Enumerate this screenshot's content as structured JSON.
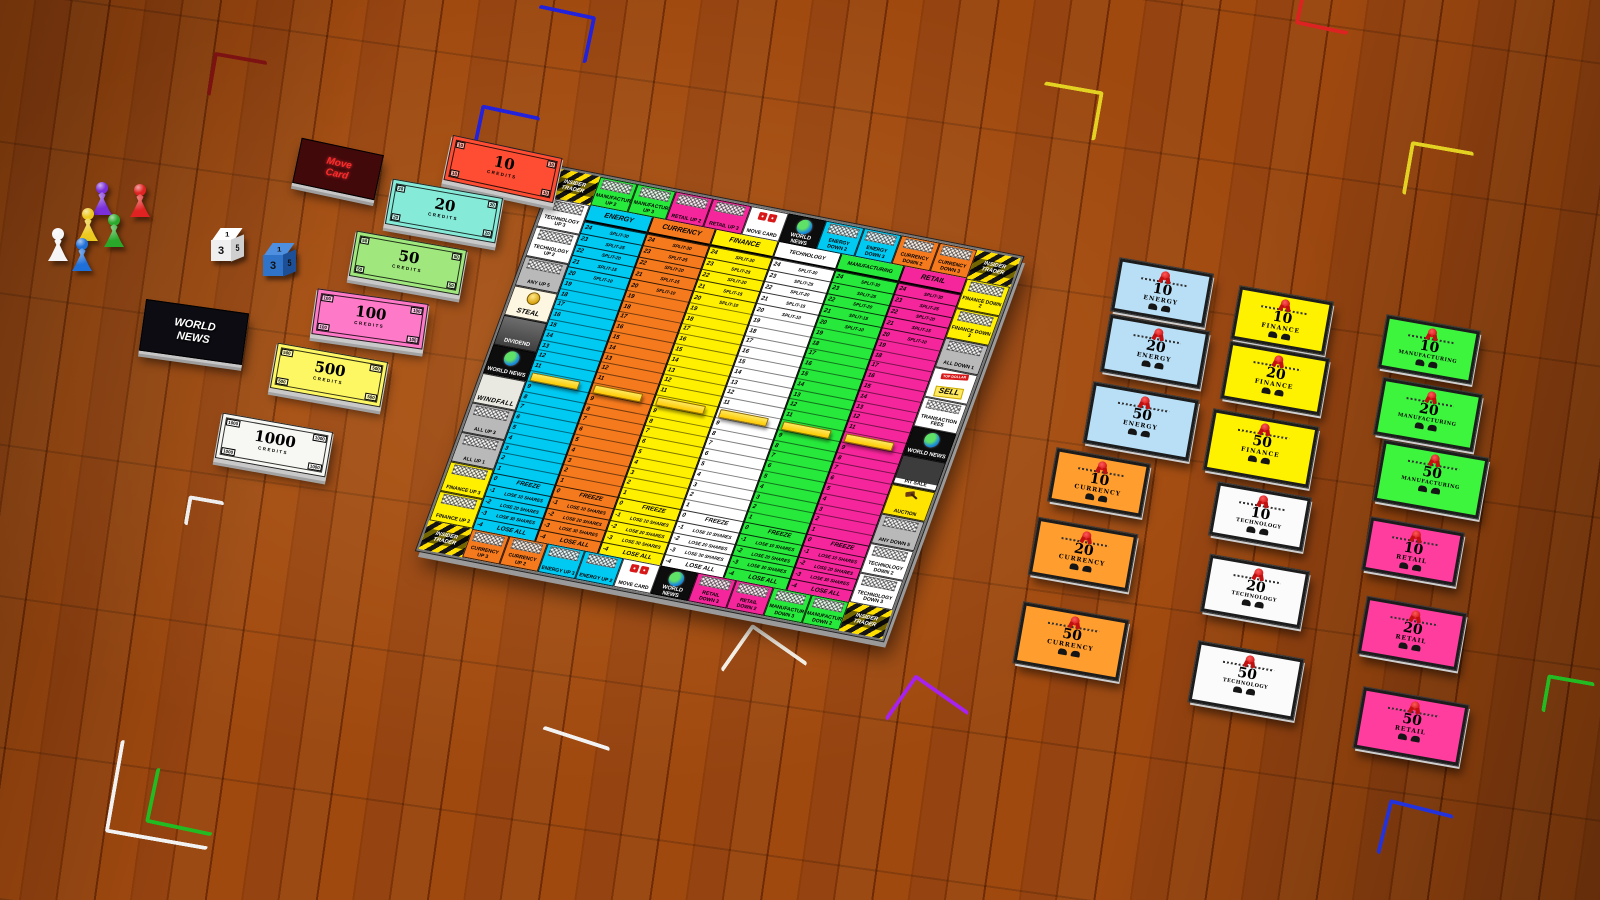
{
  "scene": {
    "marker_value": "10",
    "marker_color": "#ffd500"
  },
  "board": {
    "corner_label": "INSIDER TRADER",
    "sectors": [
      {
        "name": "ENERGY",
        "color": "#00c9f2"
      },
      {
        "name": "CURRENCY",
        "color": "#f57a1e"
      },
      {
        "name": "FINANCE",
        "color": "#fff000"
      },
      {
        "name": "TECHNOLOGY",
        "color": "#ffffff"
      },
      {
        "name": "MANUFACTURING",
        "color": "#27e93c"
      },
      {
        "name": "RETAIL",
        "color": "#f5269b"
      }
    ],
    "split_rows": [
      {
        "price": "24",
        "label": "SPLIT-30"
      },
      {
        "price": "23",
        "label": "SPLIT-25"
      },
      {
        "price": "22",
        "label": "SPLIT-20"
      },
      {
        "price": "21",
        "label": "SPLIT-15"
      },
      {
        "price": "20",
        "label": "SPLIT-10"
      }
    ],
    "price_numbers": [
      "19",
      "18",
      "17",
      "16",
      "15",
      "14",
      "13",
      "12",
      "11",
      "10",
      "9",
      "8",
      "7",
      "6",
      "5",
      "4",
      "3",
      "2",
      "1"
    ],
    "penalty_rows": [
      {
        "price": "0",
        "label": "FREEZE",
        "big": true
      },
      {
        "price": "-1",
        "label": "LOSE 10 SHARES"
      },
      {
        "price": "-2",
        "label": "LOSE 20 SHARES"
      },
      {
        "price": "-3",
        "label": "LOSE 30 SHARES"
      },
      {
        "price": "-4",
        "label": "LOSE ALL",
        "big": true
      }
    ],
    "edges": {
      "top": [
        {
          "label": "MANUFACTURING UP 2",
          "type": "green"
        },
        {
          "label": "MANUFACTURING UP 3",
          "type": "green"
        },
        {
          "label": "RETAIL UP 2",
          "type": "magenta"
        },
        {
          "label": "RETAIL UP 3",
          "type": "magenta"
        },
        {
          "label": "MOVE CARD",
          "type": "movecard"
        },
        {
          "label": "WORLD NEWS",
          "type": "news"
        },
        {
          "label": "ENERGY DOWN 2",
          "type": "cyan"
        },
        {
          "label": "ENERGY DOWN 3",
          "type": "cyan"
        },
        {
          "label": "CURRENCY DOWN 2",
          "type": "orange"
        },
        {
          "label": "CURRENCY DOWN 3",
          "type": "orange"
        }
      ],
      "right": [
        {
          "label": "FINANCE DOWN 2",
          "type": "yellow"
        },
        {
          "label": "FINANCE DOWN 3",
          "type": "yellow"
        },
        {
          "label": "ALL DOWN 1",
          "type": "gray"
        },
        {
          "label": "SELL",
          "type": "sell",
          "tag": "TOP DOLLAR"
        },
        {
          "label": "TRANSACTION FEES",
          "type": "white"
        },
        {
          "label": "WORLD NEWS",
          "type": "news"
        },
        {
          "label": "PIT SALE",
          "type": "pit"
        },
        {
          "label": "AUCTION",
          "type": "auction"
        },
        {
          "label": "ANY DOWN 5",
          "type": "gray"
        },
        {
          "label": "TECHNOLOGY DOWN 2",
          "type": "white"
        },
        {
          "label": "TECHNOLOGY DOWN 3",
          "type": "white"
        }
      ],
      "bottom": [
        {
          "label": "CURRENCY UP 3",
          "type": "orange"
        },
        {
          "label": "CURRENCY UP 2",
          "type": "orange"
        },
        {
          "label": "ENERGY UP 3",
          "type": "cyan"
        },
        {
          "label": "ENERGY UP 2",
          "type": "cyan"
        },
        {
          "label": "MOVE CARD",
          "type": "movecard"
        },
        {
          "label": "WORLD NEWS",
          "type": "news"
        },
        {
          "label": "RETAIL DOWN 3",
          "type": "magenta"
        },
        {
          "label": "RETAIL DOWN 2",
          "type": "magenta"
        },
        {
          "label": "MANUFACTURING DOWN 3",
          "type": "green"
        },
        {
          "label": "MANUFACTURING DOWN 2",
          "type": "green"
        }
      ],
      "left": [
        {
          "label": "TECHNOLOGY UP 3",
          "type": "white"
        },
        {
          "label": "TECHNOLOGY UP 2",
          "type": "white"
        },
        {
          "label": "ANY UP 5",
          "type": "gray"
        },
        {
          "label": "STEAL",
          "type": "steal"
        },
        {
          "label": "DIVIDEND",
          "type": "dividend"
        },
        {
          "label": "WORLD NEWS",
          "type": "news"
        },
        {
          "label": "WINDFALL",
          "type": "windfall"
        },
        {
          "label": "ALL UP 3",
          "type": "gray"
        },
        {
          "label": "ALL UP 1",
          "type": "gray"
        },
        {
          "label": "FINANCE UP 3",
          "type": "yellow"
        },
        {
          "label": "FINANCE UP 2",
          "type": "yellow"
        }
      ]
    }
  },
  "money_notes": [
    {
      "value": "10",
      "label": "CREDITS",
      "color": "#ff4d33",
      "x": 447,
      "y": 146,
      "rot": 12
    },
    {
      "value": "20",
      "label": "CREDITS",
      "color": "#86ead9",
      "x": 388,
      "y": 188,
      "rot": 10
    },
    {
      "value": "50",
      "label": "CREDITS",
      "color": "#a0e87d",
      "x": 352,
      "y": 240,
      "rot": 10
    },
    {
      "value": "100",
      "label": "CREDITS",
      "color": "#ff79c9",
      "x": 314,
      "y": 296,
      "rot": 8
    },
    {
      "value": "500",
      "label": "CREDITS",
      "color": "#fdf763",
      "x": 273,
      "y": 352,
      "rot": 10
    },
    {
      "value": "1000",
      "label": "CREDITS",
      "color": "#f7f7f3",
      "x": 218,
      "y": 422,
      "rot": 10
    }
  ],
  "decks": {
    "move": {
      "label": "Move Card",
      "x": 296,
      "y": 146,
      "w": 84,
      "h": 46,
      "rot": 12,
      "bg": "#42090b",
      "text": "#ff2a2a"
    },
    "news": {
      "label": "WORLD NEWS",
      "x": 142,
      "y": 306,
      "w": 104,
      "h": 52,
      "rot": 8,
      "bg": "#0c0c12",
      "text": "#ffffff"
    }
  },
  "dice": [
    {
      "name": "white-die",
      "top": "1",
      "front": "3",
      "right": "5",
      "x": 210,
      "y": 228,
      "c_top": "#ffffff",
      "c_front": "#efefef",
      "c_right": "#cfcfcf"
    },
    {
      "name": "blue-die",
      "top": "1",
      "front": "3",
      "right": "5",
      "x": 262,
      "y": 243,
      "c_top": "#4e8fe0",
      "c_front": "#2f74c8",
      "c_right": "#1d4f96"
    }
  ],
  "pawns": [
    {
      "color_name": "purple",
      "color": "#7a2fd8",
      "x": 92,
      "y": 182
    },
    {
      "color_name": "red",
      "color": "#e02222",
      "x": 130,
      "y": 184
    },
    {
      "color_name": "yellow",
      "color": "#ecc91f",
      "x": 78,
      "y": 208
    },
    {
      "color_name": "green",
      "color": "#2aa82a",
      "x": 104,
      "y": 214
    },
    {
      "color_name": "white",
      "color": "#f5f5f5",
      "x": 48,
      "y": 228
    },
    {
      "color_name": "blue",
      "color": "#1f6fd8",
      "x": 72,
      "y": 238
    }
  ],
  "certificates": [
    {
      "sector": "ENERGY",
      "color": "#b8dff6",
      "cards": [
        {
          "value": "10",
          "x": 1115,
          "y": 266
        },
        {
          "value": "20",
          "x": 1105,
          "y": 323
        },
        {
          "value": "50",
          "x": 1088,
          "y": 391
        }
      ]
    },
    {
      "sector": "FINANCE",
      "color": "#fff200",
      "cards": [
        {
          "value": "10",
          "x": 1235,
          "y": 294
        },
        {
          "value": "20",
          "x": 1225,
          "y": 350
        },
        {
          "value": "50",
          "x": 1208,
          "y": 418
        }
      ]
    },
    {
      "sector": "MANUFACTURING",
      "color": "#3df53d",
      "cards": [
        {
          "value": "10",
          "x": 1382,
          "y": 323
        },
        {
          "value": "20",
          "x": 1378,
          "y": 386
        },
        {
          "value": "50",
          "x": 1378,
          "y": 449
        }
      ]
    },
    {
      "sector": "CURRENCY",
      "color": "#ff9d2e",
      "cards": [
        {
          "value": "10",
          "x": 1052,
          "y": 456
        },
        {
          "value": "20",
          "x": 1033,
          "y": 526
        },
        {
          "value": "50",
          "x": 1018,
          "y": 611
        }
      ]
    },
    {
      "sector": "TECHNOLOGY",
      "color": "#fbfbfb",
      "cards": [
        {
          "value": "10",
          "x": 1213,
          "y": 490
        },
        {
          "value": "20",
          "x": 1205,
          "y": 563
        },
        {
          "value": "50",
          "x": 1193,
          "y": 650
        }
      ]
    },
    {
      "sector": "RETAIL",
      "color": "#ff3d9e",
      "cards": [
        {
          "value": "10",
          "x": 1366,
          "y": 525
        },
        {
          "value": "20",
          "x": 1362,
          "y": 605
        },
        {
          "value": "50",
          "x": 1358,
          "y": 696
        }
      ]
    }
  ],
  "hand_markers": [
    {
      "color": "#7c1212",
      "x": 210,
      "y": 56,
      "w": 50,
      "h": 40,
      "rot": 10,
      "corner": "tl"
    },
    {
      "color": "#2222dd",
      "x": 534,
      "y": 10,
      "w": 54,
      "h": 44,
      "rot": 12,
      "corner": "tr"
    },
    {
      "color": "#2222dd",
      "x": 476,
      "y": 110,
      "w": 56,
      "h": 44,
      "rot": 12,
      "corner": "tl"
    },
    {
      "color": "#e3d222",
      "x": 1040,
      "y": 86,
      "w": 56,
      "h": 46,
      "rot": 10,
      "corner": "tr"
    },
    {
      "color": "#e3d222",
      "x": 1406,
      "y": 146,
      "w": 60,
      "h": 50,
      "rot": 10,
      "corner": "tl"
    },
    {
      "color": "#dd2222",
      "x": 1298,
      "y": -8,
      "w": 50,
      "h": 34,
      "rot": 12,
      "corner": "bl"
    },
    {
      "color": "#eeeeee",
      "x": 186,
      "y": 498,
      "w": 32,
      "h": 26,
      "rot": 10,
      "corner": "tl"
    },
    {
      "color": "#f4efe4",
      "x": 730,
      "y": 638,
      "w": 64,
      "h": 52,
      "rot": 35,
      "corner": "tl"
    },
    {
      "color": "#a722ee",
      "x": 894,
      "y": 688,
      "w": 62,
      "h": 50,
      "rot": 35,
      "corner": "tl"
    },
    {
      "color": "#22bb22",
      "x": 150,
      "y": 774,
      "w": 64,
      "h": 52,
      "rot": 12,
      "corner": "bl"
    },
    {
      "color": "#f2f2f2",
      "x": 112,
      "y": 748,
      "w": 100,
      "h": 90,
      "rot": 10,
      "corner": "bl"
    },
    {
      "color": "#2233dd",
      "x": 1382,
      "y": 806,
      "w": 62,
      "h": 52,
      "rot": 14,
      "corner": "tl"
    },
    {
      "color": "#22bb22",
      "x": 1544,
      "y": 678,
      "w": 44,
      "h": 34,
      "rot": 10,
      "corner": "tl"
    },
    {
      "color": "#f2f2f2",
      "x": 540,
      "y": 736,
      "w": 70,
      "h": 10,
      "rot": 18,
      "corner": "line"
    }
  ]
}
